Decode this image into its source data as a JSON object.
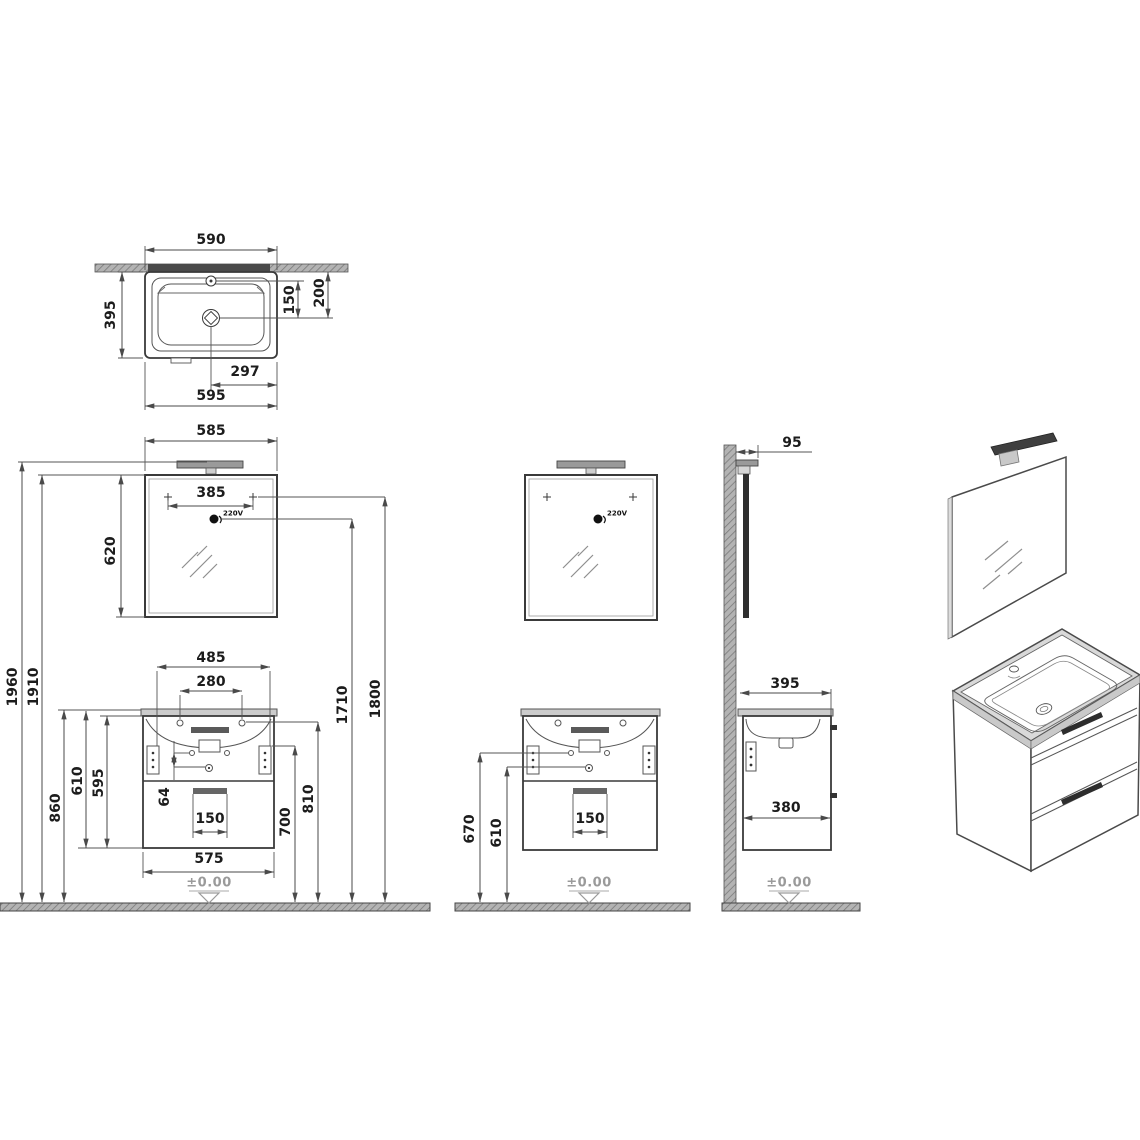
{
  "drawing_type": "bathroom vanity unit technical drawing",
  "labels": {
    "level": "±0.00",
    "voltage": "220V"
  },
  "dims": {
    "top": {
      "top_width": "590",
      "depth": "395",
      "faucet_to_drain": "150",
      "wall_to_drain": "200",
      "drain_to_edge": "297",
      "bottom_width": "595"
    },
    "front": {
      "mirror_width": "585",
      "mirror_hole_spacing": "385",
      "mirror_height": "620",
      "total_height": "1960",
      "mirror_top_height": "1910",
      "basin_top_height": "860",
      "basin_cabinet_height": "610",
      "cabinet_height": "595",
      "bracket_spacing": "485",
      "hole_spacing": "280",
      "hole_offset": "64",
      "drain_width": "150",
      "trap_height": "700",
      "bracket_height": "810",
      "socket_height": "1710",
      "hole_height": "1800",
      "cabinet_width": "575"
    },
    "center": {
      "bracket_height": "670",
      "hole_height": "610",
      "drain_width": "150"
    },
    "side": {
      "light_depth": "95",
      "basin_depth": "395",
      "cabinet_depth": "380"
    }
  },
  "colors": {
    "line": "#3a3a3a",
    "dim_line": "#4a4a4a",
    "text": "#1c1c1c",
    "hatch_fill": "#b3b3b3",
    "hatch_stroke": "#7a7a7a",
    "rim_fill": "#cccccc",
    "faint": "#9a9a9a"
  }
}
